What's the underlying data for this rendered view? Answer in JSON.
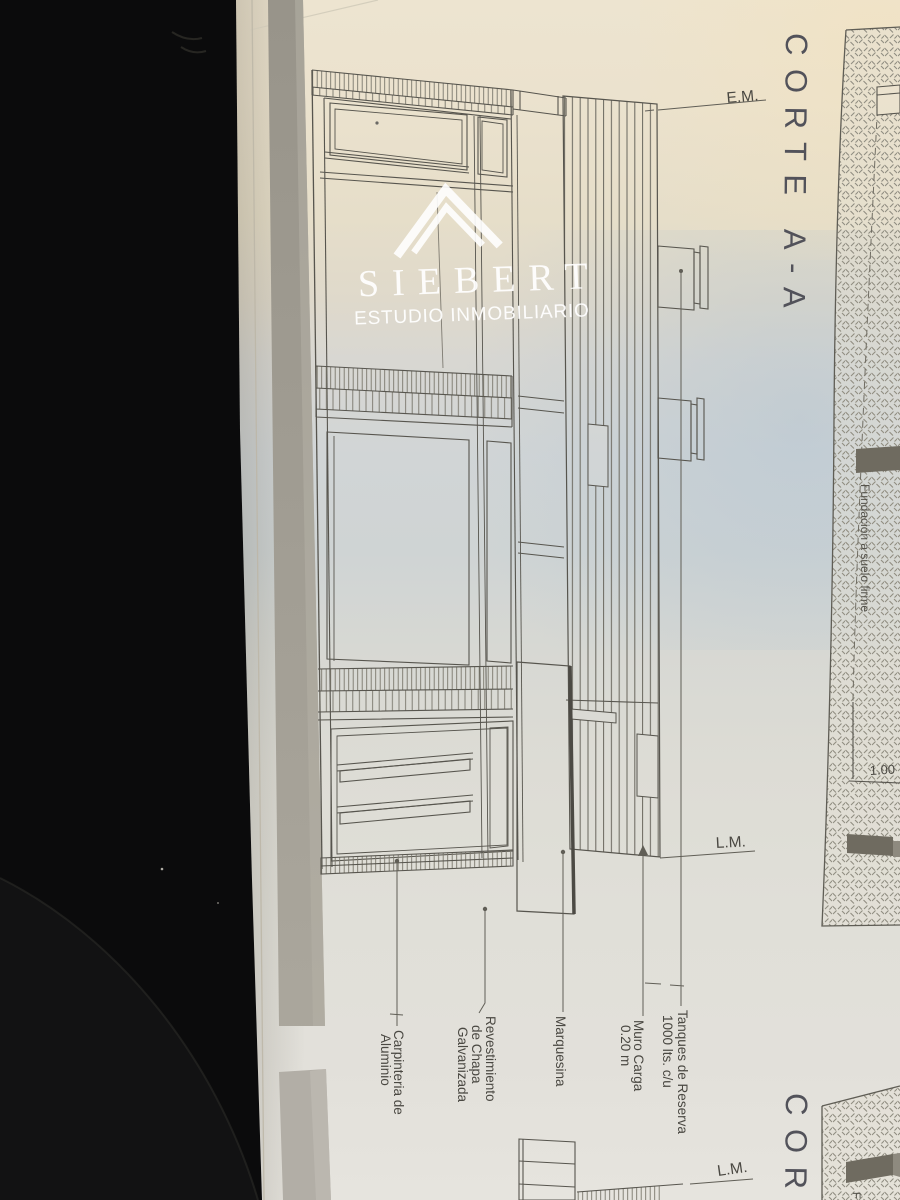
{
  "watermark": {
    "brand": "SIEBERT",
    "tagline": "ESTUDIO INMOBILIARIO"
  },
  "titles": {
    "section_a": "CORTE A-A",
    "section_b_partial": "COR"
  },
  "annotations": {
    "em": "E.M.",
    "lm": "L.M.",
    "lm_2": "L.M.",
    "dim": "1.00",
    "foundation": "Fundación a suelo firme",
    "foundation_partial": "F",
    "labels": {
      "carpinteria": [
        "Carpinteria de",
        "Aluminio"
      ],
      "revestimiento": [
        "Revestimiento",
        "de Chapa",
        "Galvanizada"
      ],
      "marquesina": [
        "Marquesina"
      ],
      "muro": [
        "Muro Carga",
        "0.20 m"
      ],
      "tanques": [
        "Tanques de Reserva",
        "1000 lts. c/u"
      ]
    }
  },
  "icons": {
    "watermark_logo": "triangle-chevron"
  },
  "colors": {
    "background": "#0b0b0c",
    "paper_warm": "#ece3cf",
    "paper_cool": "#ced3d4",
    "ink": "#56544d",
    "title_ink": "#4f4f57",
    "hatch": "#908d81",
    "gray_band": "#a09c92",
    "foundation_fill": "#6f6b60",
    "watermark_white": "#ffffff"
  }
}
